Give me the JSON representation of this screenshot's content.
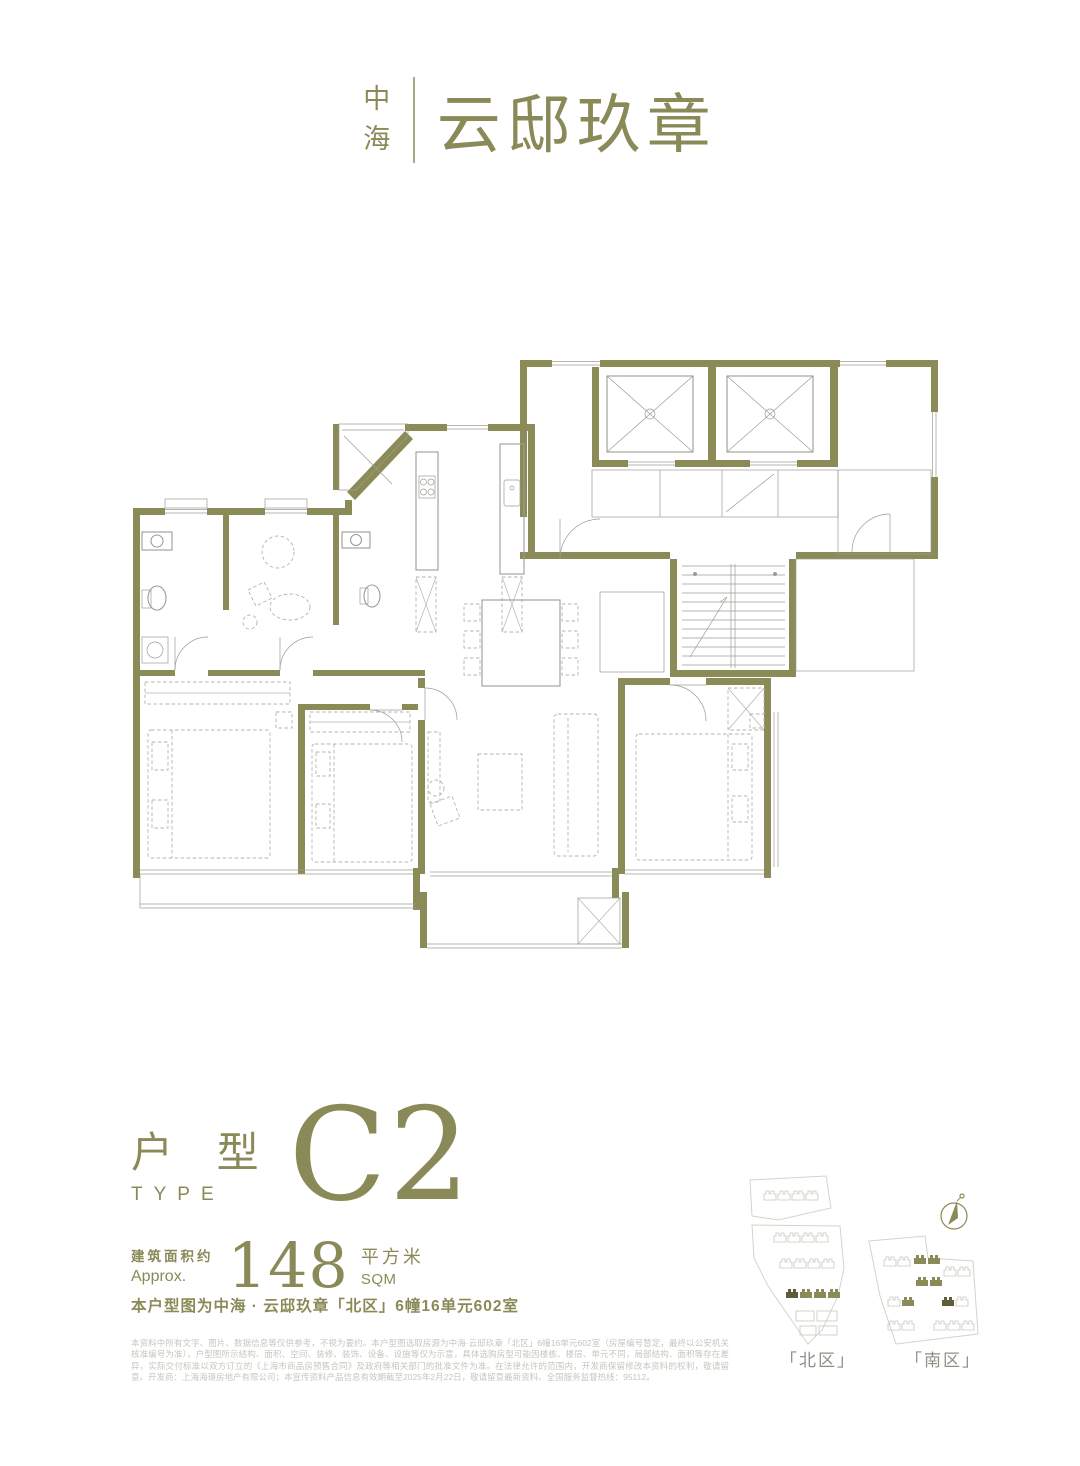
{
  "brand": {
    "name_char_1": "中",
    "name_char_2": "海",
    "project_name": "云邸玖章"
  },
  "type_info": {
    "label_cn": "户 型",
    "label_en": "TYPE",
    "code": "C2"
  },
  "area": {
    "label_cn": "建筑面积约",
    "label_en": "Approx.",
    "value": "148",
    "unit_cn": "平方米",
    "unit_en": "SQM"
  },
  "unit_description": "本户型图为中海 · 云邸玖章「北区」6幢16单元602室",
  "disclaimer": "本资料中所有文字、图片、数据信息等仅供参考，不视为要约。本户型图选取房源为中海·云邸玖章「北区」6幢16单元602室（房屋编号暂定，最终以公安机关核准编号为准），户型图所示结构、面积、空间、装修、装饰、设备、设施等仅为示意，具体选购房型可能因楼栋、楼层、单元不同，局部结构、面积等存在差异，实际交付标准以双方订立的《上海市商品房预售合同》及政府等相关部门的批准文件为准。在法律允许的范围内，开发商保留修改本资料的权利，敬请留意。开发商：上海海璟房地产有限公司；本宣传资料产品信息有效期截至2025年2月22日，敬请留意最新资料。全国服务监督热线：95112。",
  "site_map": {
    "north_label": "「北区」",
    "south_label": "「南区」"
  },
  "colors": {
    "olive_wall": "#8b8b57",
    "olive_text": "#8a8a58",
    "thin_line": "#9c9c94",
    "furniture_dash": "#b5b5ab",
    "disclaimer_text": "#c6c6be"
  }
}
